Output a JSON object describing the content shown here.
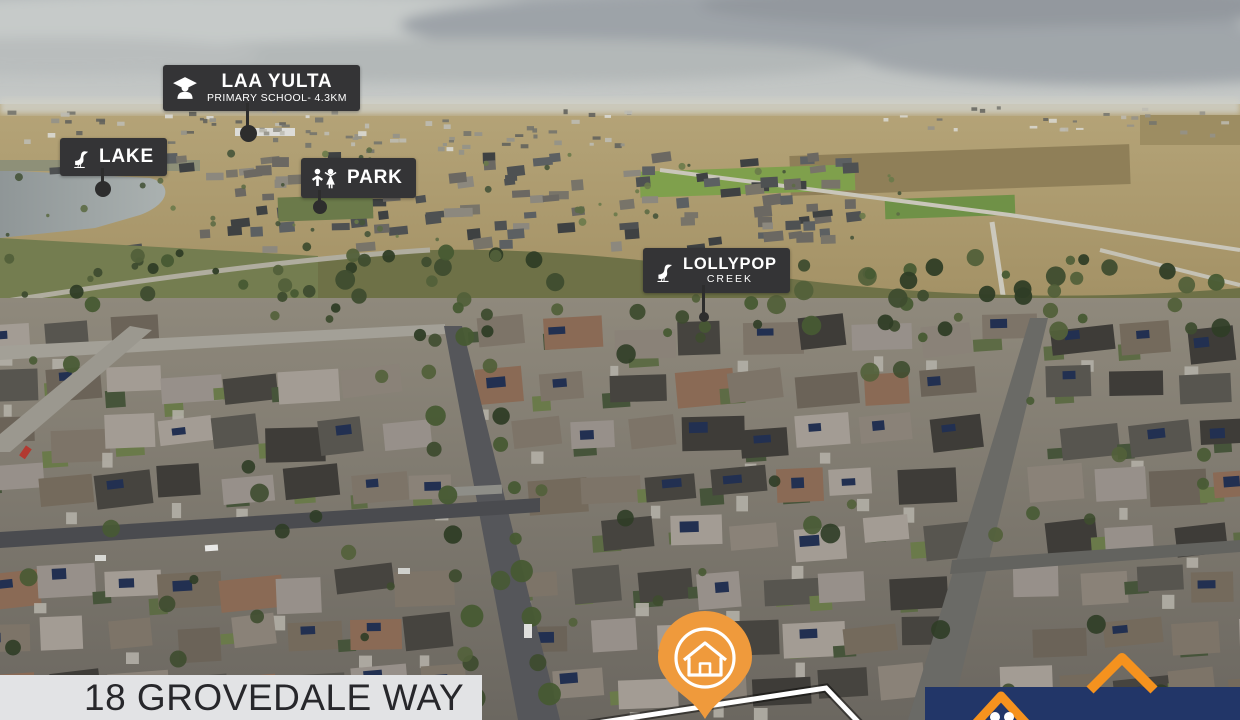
{
  "markers": {
    "school": {
      "title": "LAA YULTA",
      "subtitle": "PRIMARY SCHOOL- 4.3KM",
      "icon": "graduate-cap"
    },
    "lake": {
      "title": "LAKE",
      "icon": "heron"
    },
    "park": {
      "title": "PARK",
      "icon": "children"
    },
    "creek": {
      "title": "LOLLYPOP",
      "subtitle": "CREEK",
      "icon": "heron"
    }
  },
  "property": {
    "address": "18 GROVEDALE WAY",
    "pin_icon": "house",
    "boundary_style": "white-outline"
  },
  "logo": {
    "icons": [
      "roof-chevron-small",
      "roof-chevron-large",
      "two-dots"
    ]
  },
  "colors": {
    "pin_orange": "#EF9A3C",
    "logo_orange": "#F5921E",
    "logo_navy": "#223668",
    "label_bg": "#343436",
    "label_text": "#FFFFFF",
    "banner_bg": "#E2E3E5",
    "banner_text": "#27272B",
    "marker_stick": "#2D2D2D",
    "boundary_white": "#FFFFFF"
  }
}
